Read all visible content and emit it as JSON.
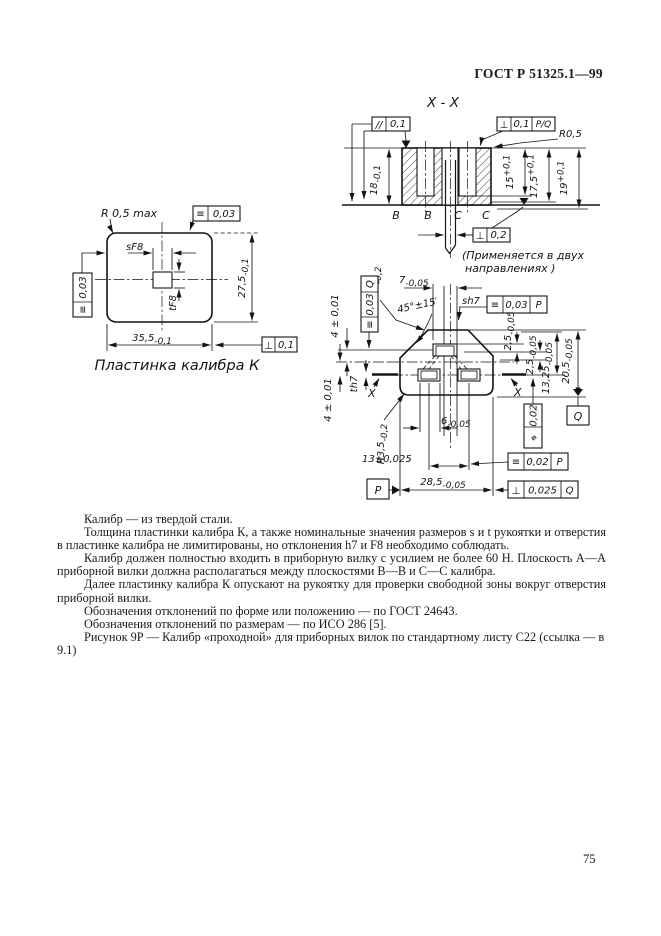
{
  "page": {
    "header": "ГОСТ Р 51325.1—99",
    "number": "75"
  },
  "section_view": {
    "title": "X - X",
    "parallel_frame": {
      "sym": "//",
      "val": "0,1"
    },
    "perp_frame": {
      "sym": "⊥",
      "val": "0,1",
      "datum": "P/Q"
    },
    "radius": "R0,5",
    "dim_18": {
      "v": "18",
      "t": "-0,1"
    },
    "dim_15": {
      "v": "15",
      "t": "+0,1"
    },
    "dim_17_5": {
      "v": "17,5",
      "t": "+0,1"
    },
    "dim_19": {
      "v": "19",
      "t": "+0,1"
    },
    "plane_b": "B",
    "plane_c": "C",
    "perp_pin_frame": {
      "sym": "⊥",
      "val": "0,2"
    },
    "note_line1": "(Применяется в двух",
    "note_line2": "направлениях )"
  },
  "plate_view": {
    "radius": "R 0,5 max",
    "flat_top_frame": {
      "sym": "≡",
      "val": "0,03"
    },
    "flat_left_frame": {
      "sym": "≡",
      "val": "0,03"
    },
    "dim_s": "sF8",
    "dim_t": "tF8",
    "dim_width": {
      "v": "35,5",
      "t": "-0,1"
    },
    "dim_height": {
      "v": "27,5",
      "t": "-0,1"
    },
    "perp_frame": {
      "sym": "⊥",
      "val": "0,1"
    },
    "caption": "Пластинка калибра К"
  },
  "gauge_view": {
    "dim_7": {
      "v": "7",
      "t": "-0,05"
    },
    "radius_r3": {
      "v": "R3",
      "t": "-0,2"
    },
    "angle": "45°±15′",
    "label_sh7": "sh7",
    "sym_frame_p": {
      "sym": "≡",
      "val": "0,03",
      "datum": "P"
    },
    "sym_frame_q": {
      "sym": "≡",
      "val": "0,03",
      "datum": "Q"
    },
    "dim_4_top": "4 ± 0,01",
    "dim_4_bottom": "4 ± 0,01",
    "label_th7": "th7",
    "label_x": "X",
    "dim_2_5_a": {
      "v": "2,5",
      "t": "-0,05"
    },
    "dim_2_5_b": {
      "v": "2,5",
      "t": "-0,05"
    },
    "dim_13_25": {
      "v": "13,25",
      "t": "-0,05"
    },
    "dim_20_5": {
      "v": "20,5",
      "t": "-0,05"
    },
    "pos_frame": {
      "sym": "⌖",
      "val": "0,02"
    },
    "datum_q": "Q",
    "datum_p": "P",
    "dim_6": {
      "v": "6",
      "t": "-0,05"
    },
    "dim_13": "13±0,025",
    "dim_28_5": {
      "v": "28,5",
      "t": "-0,05"
    },
    "radius_r3_5": {
      "v": "R3,5",
      "t": "-0,2"
    },
    "sym_frame_p2": {
      "sym": "≡",
      "val": "0,02",
      "datum": "P"
    },
    "perp_frame_q": {
      "sym": "⊥",
      "val": "0,025",
      "datum": "Q"
    }
  },
  "text": {
    "paragraphs": [
      "Калибр — из твердой стали.",
      "Толщина пластинки калибра К, а также номинальные значения размеров s и t рукоятки и отверстия в пластинке калибра не лимитированы, но отклонения h7 и F8 необходимо соблюдать.",
      "Калибр должен полностью входить в приборную вилку с усилием не более 60 Н. Плоскость А—А приборной вилки должна располагаться между плоскостями В—В и С—С калибра.",
      "Далее пластинку калибра К опускают на рукоятку для проверки свободной зоны вокруг отверстия приборной вилки.",
      "Обозначения отклонений по форме или положению — по ГОСТ 24643.",
      "Обозначения отклонений по размерам — по ИСО 286 [5]."
    ],
    "figure_caption": "Рисунок 9Р — Калибр «проходной» для приборных вилок по стандартному листу С22 (ссылка — в 9.1)"
  }
}
